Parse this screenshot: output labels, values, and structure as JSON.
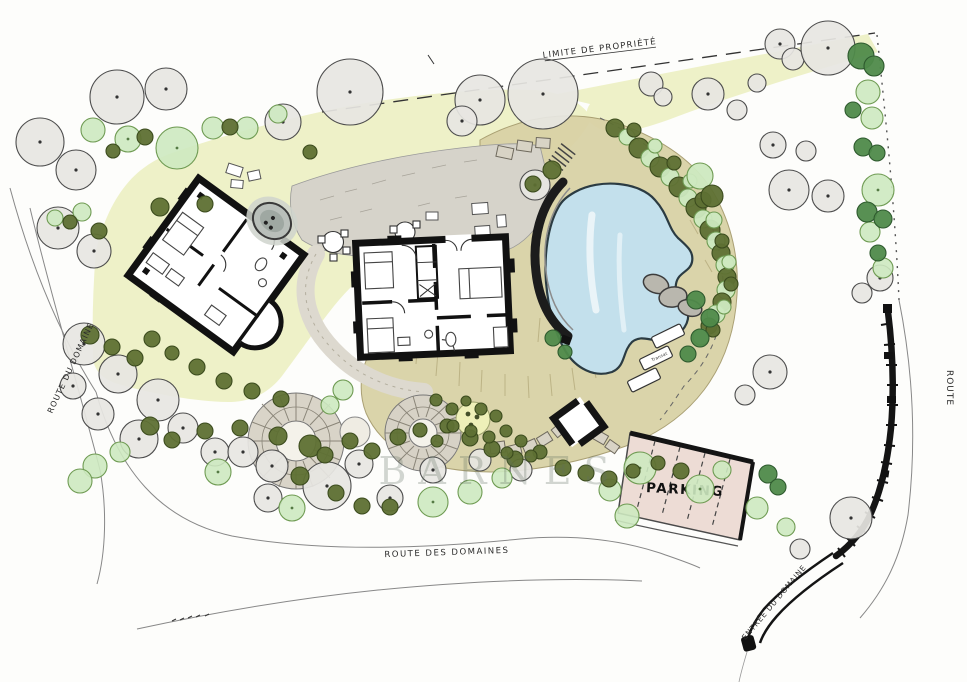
{
  "labels": {
    "property_limit": "LIMITE DE PROPRIÉTÉ",
    "route_left": "ROUTE DU DOMAINE",
    "route_bottom": "ROUTE DES DOMAINES",
    "route_right": "ROUTE",
    "entrance": "ENTRÉE DU DOMAINE",
    "parking": "PARKING",
    "transat": "Transat",
    "watermark": "BARNES"
  },
  "colors": {
    "paper": "#fdfdfb",
    "lawn": "#edf0c5",
    "ground": "#d9d2a6",
    "pool_water": "#c3e0ec",
    "parking": "#eddcd5",
    "courtyard": "#d6d3ca",
    "tree_gray": "#e7e6e2",
    "tree_light_green": "#cde9c0",
    "bush_olive": "#5e7033",
    "tree_mid_green": "#4f8a4a",
    "ink": "#141414"
  },
  "plan": {
    "gray_trees": [
      [
        40,
        142,
        24
      ],
      [
        76,
        170,
        20
      ],
      [
        117,
        97,
        27
      ],
      [
        166,
        89,
        21
      ],
      [
        58,
        228,
        21
      ],
      [
        94,
        251,
        17
      ],
      [
        283,
        122,
        18
      ],
      [
        350,
        92,
        33
      ],
      [
        480,
        100,
        25
      ],
      [
        462,
        121,
        15
      ],
      [
        543,
        94,
        35
      ],
      [
        651,
        84,
        12
      ],
      [
        663,
        97,
        9
      ],
      [
        708,
        94,
        16
      ],
      [
        737,
        110,
        10
      ],
      [
        780,
        44,
        15
      ],
      [
        793,
        59,
        11
      ],
      [
        828,
        48,
        27
      ],
      [
        757,
        83,
        9
      ],
      [
        773,
        145,
        13
      ],
      [
        806,
        151,
        10
      ],
      [
        789,
        190,
        20
      ],
      [
        828,
        196,
        16
      ],
      [
        880,
        278,
        13
      ],
      [
        862,
        293,
        10
      ],
      [
        770,
        372,
        17
      ],
      [
        745,
        395,
        10
      ],
      [
        84,
        344,
        21
      ],
      [
        118,
        374,
        19
      ],
      [
        158,
        400,
        21
      ],
      [
        98,
        414,
        16
      ],
      [
        139,
        439,
        19
      ],
      [
        183,
        428,
        15
      ],
      [
        73,
        386,
        13
      ],
      [
        215,
        452,
        14
      ],
      [
        243,
        452,
        15
      ],
      [
        272,
        466,
        16
      ],
      [
        327,
        486,
        24
      ],
      [
        268,
        498,
        14
      ],
      [
        359,
        464,
        14
      ],
      [
        390,
        498,
        13
      ],
      [
        433,
        470,
        13
      ],
      [
        480,
        460,
        11
      ],
      [
        521,
        470,
        11
      ],
      [
        851,
        518,
        21
      ],
      [
        800,
        549,
        10
      ],
      [
        535,
        185,
        15
      ]
    ],
    "light_trees": [
      [
        93,
        130,
        12
      ],
      [
        128,
        139,
        13
      ],
      [
        177,
        148,
        21
      ],
      [
        213,
        128,
        11
      ],
      [
        247,
        128,
        11
      ],
      [
        278,
        114,
        9
      ],
      [
        868,
        92,
        12
      ],
      [
        872,
        118,
        11
      ],
      [
        878,
        190,
        16
      ],
      [
        870,
        232,
        10
      ],
      [
        883,
        268,
        10
      ],
      [
        95,
        466,
        12
      ],
      [
        80,
        481,
        12
      ],
      [
        120,
        452,
        10
      ],
      [
        218,
        472,
        13
      ],
      [
        292,
        508,
        13
      ],
      [
        433,
        502,
        15
      ],
      [
        470,
        492,
        12
      ],
      [
        502,
        478,
        10
      ],
      [
        610,
        490,
        11
      ],
      [
        640,
        468,
        16
      ],
      [
        700,
        489,
        14
      ],
      [
        722,
        470,
        9
      ],
      [
        757,
        508,
        11
      ],
      [
        786,
        527,
        9
      ],
      [
        627,
        516,
        12
      ],
      [
        55,
        218,
        8
      ],
      [
        82,
        212,
        9
      ],
      [
        343,
        390,
        10
      ],
      [
        330,
        405,
        9
      ]
    ],
    "olive_bushes": [
      [
        145,
        137,
        8
      ],
      [
        230,
        127,
        8
      ],
      [
        310,
        152,
        7
      ],
      [
        113,
        151,
        7
      ],
      [
        99,
        231,
        8
      ],
      [
        70,
        222,
        7
      ],
      [
        90,
        335,
        9
      ],
      [
        112,
        347,
        8
      ],
      [
        135,
        358,
        8
      ],
      [
        152,
        339,
        8
      ],
      [
        172,
        353,
        7
      ],
      [
        197,
        367,
        8
      ],
      [
        224,
        381,
        8
      ],
      [
        252,
        391,
        8
      ],
      [
        281,
        399,
        8
      ],
      [
        150,
        426,
        9
      ],
      [
        172,
        440,
        8
      ],
      [
        205,
        431,
        8
      ],
      [
        240,
        428,
        8
      ],
      [
        278,
        436,
        9
      ],
      [
        310,
        446,
        11
      ],
      [
        325,
        455,
        8
      ],
      [
        350,
        441,
        8
      ],
      [
        372,
        451,
        8
      ],
      [
        398,
        437,
        8
      ],
      [
        420,
        430,
        7
      ],
      [
        447,
        426,
        7
      ],
      [
        470,
        438,
        8
      ],
      [
        492,
        449,
        8
      ],
      [
        515,
        459,
        8
      ],
      [
        540,
        452,
        7
      ],
      [
        563,
        468,
        8
      ],
      [
        586,
        473,
        8
      ],
      [
        609,
        479,
        8
      ],
      [
        633,
        471,
        7
      ],
      [
        658,
        463,
        7
      ],
      [
        681,
        471,
        8
      ],
      [
        300,
        476,
        9
      ],
      [
        336,
        493,
        8
      ],
      [
        362,
        506,
        8
      ],
      [
        390,
        507,
        8
      ],
      [
        436,
        400,
        6
      ],
      [
        452,
        409,
        6
      ],
      [
        466,
        401,
        5
      ],
      [
        481,
        409,
        6
      ],
      [
        496,
        416,
        6
      ],
      [
        453,
        426,
        6
      ],
      [
        471,
        431,
        6
      ],
      [
        489,
        437,
        6
      ],
      [
        506,
        431,
        6
      ],
      [
        521,
        441,
        6
      ],
      [
        437,
        441,
        6
      ],
      [
        507,
        453,
        6
      ],
      [
        531,
        456,
        6
      ],
      [
        552,
        170,
        9
      ],
      [
        533,
        184,
        8
      ],
      [
        160,
        207,
        9
      ],
      [
        205,
        204,
        8
      ]
    ],
    "dark_trees": [
      [
        861,
        56,
        13
      ],
      [
        874,
        66,
        10
      ],
      [
        853,
        110,
        8
      ],
      [
        863,
        147,
        9
      ],
      [
        877,
        153,
        8
      ],
      [
        867,
        212,
        10
      ],
      [
        883,
        219,
        9
      ],
      [
        878,
        253,
        8
      ],
      [
        768,
        474,
        9
      ],
      [
        778,
        487,
        8
      ],
      [
        553,
        338,
        8
      ],
      [
        565,
        352,
        7
      ],
      [
        696,
        300,
        9
      ],
      [
        710,
        318,
        9
      ],
      [
        700,
        338,
        9
      ],
      [
        688,
        354,
        8
      ]
    ],
    "band_trees": [
      [
        615,
        128,
        9
      ],
      [
        627,
        137,
        8
      ],
      [
        639,
        148,
        10
      ],
      [
        650,
        158,
        9
      ],
      [
        660,
        167,
        10
      ],
      [
        670,
        177,
        9
      ],
      [
        679,
        187,
        10
      ],
      [
        688,
        198,
        9
      ],
      [
        696,
        208,
        10
      ],
      [
        703,
        219,
        9
      ],
      [
        710,
        230,
        10
      ],
      [
        716,
        241,
        9
      ],
      [
        721,
        253,
        9
      ],
      [
        725,
        265,
        9
      ],
      [
        727,
        277,
        9
      ],
      [
        726,
        290,
        9
      ],
      [
        722,
        302,
        9
      ],
      [
        716,
        314,
        9
      ],
      [
        709,
        326,
        8
      ],
      [
        701,
        337,
        8
      ],
      [
        634,
        130,
        7
      ],
      [
        655,
        146,
        7
      ],
      [
        674,
        163,
        7
      ],
      [
        690,
        181,
        7
      ],
      [
        703,
        200,
        8
      ],
      [
        714,
        220,
        8
      ],
      [
        722,
        241,
        7
      ],
      [
        729,
        262,
        7
      ],
      [
        731,
        284,
        7
      ],
      [
        724,
        307,
        7
      ],
      [
        713,
        330,
        7
      ],
      [
        700,
        176,
        13
      ],
      [
        712,
        196,
        11
      ]
    ]
  }
}
